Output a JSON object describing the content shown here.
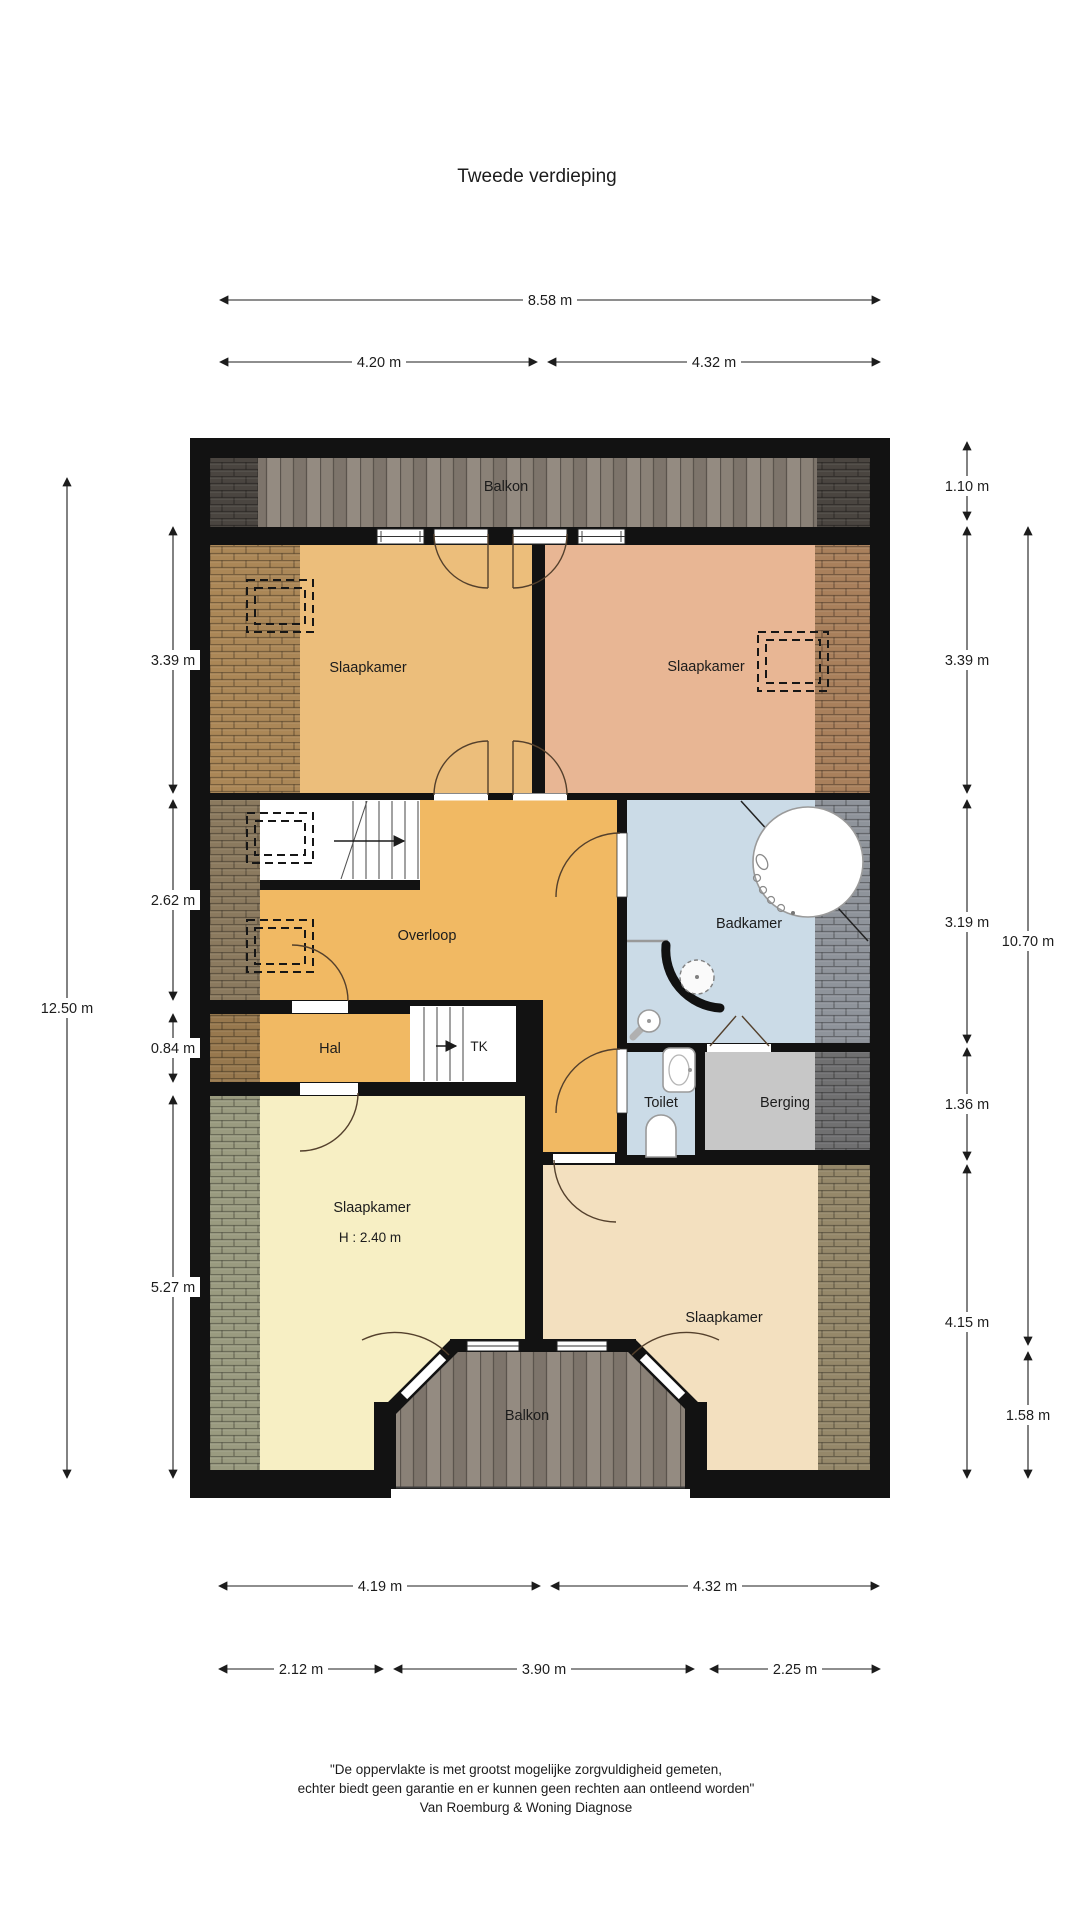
{
  "title": "Tweede verdieping",
  "rooms": {
    "balkon_top": "Balkon",
    "slaapkamer_tl": "Slaapkamer",
    "slaapkamer_tr": "Slaapkamer",
    "overloop": "Overloop",
    "badkamer": "Badkamer",
    "hal": "Hal",
    "tk": "TK",
    "toilet": "Toilet",
    "berging": "Berging",
    "slaapkamer_bl": "Slaapkamer",
    "slaapkamer_bl_height": "H : 2.40 m",
    "slaapkamer_br": "Slaapkamer",
    "balkon_bottom": "Balkon"
  },
  "dimensions": {
    "top": {
      "total": "8.58 m",
      "left": "4.20 m",
      "right": "4.32 m"
    },
    "bottom": {
      "row1_left": "4.19 m",
      "row1_right": "4.32 m",
      "row2_left": "2.12 m",
      "row2_mid": "3.90 m",
      "row2_right": "2.25 m"
    },
    "left": {
      "total": "12.50 m",
      "seg1": "3.39 m",
      "seg2": "2.62 m",
      "seg3": "0.84 m",
      "seg4": "5.27 m"
    },
    "right": {
      "seg1": "1.10 m",
      "seg2": "3.39 m",
      "seg3": "3.19 m",
      "seg4": "1.36 m",
      "seg5": "4.15 m",
      "total": "10.70 m",
      "balkon": "1.58 m"
    }
  },
  "footer": {
    "line1": "\"De oppervlakte is met grootst mogelijke zorgvuldigheid gemeten,",
    "line2": "echter biedt geen garantie en er kunnen geen rechten aan ontleend worden\"",
    "line3": "Van Roemburg & Woning Diagnose"
  },
  "colors": {
    "wall": "#121212",
    "slaapkamer_tl": "#ecbe7b",
    "slaapkamer_tr": "#e8b694",
    "overloop": "#f1b963",
    "badkamer": "#cbdbe7",
    "toilet": "#cbdbe7",
    "berging": "#c7c7c7",
    "slaapkamer_bl": "#f7efc4",
    "slaapkamer_br": "#f3e0bf"
  }
}
